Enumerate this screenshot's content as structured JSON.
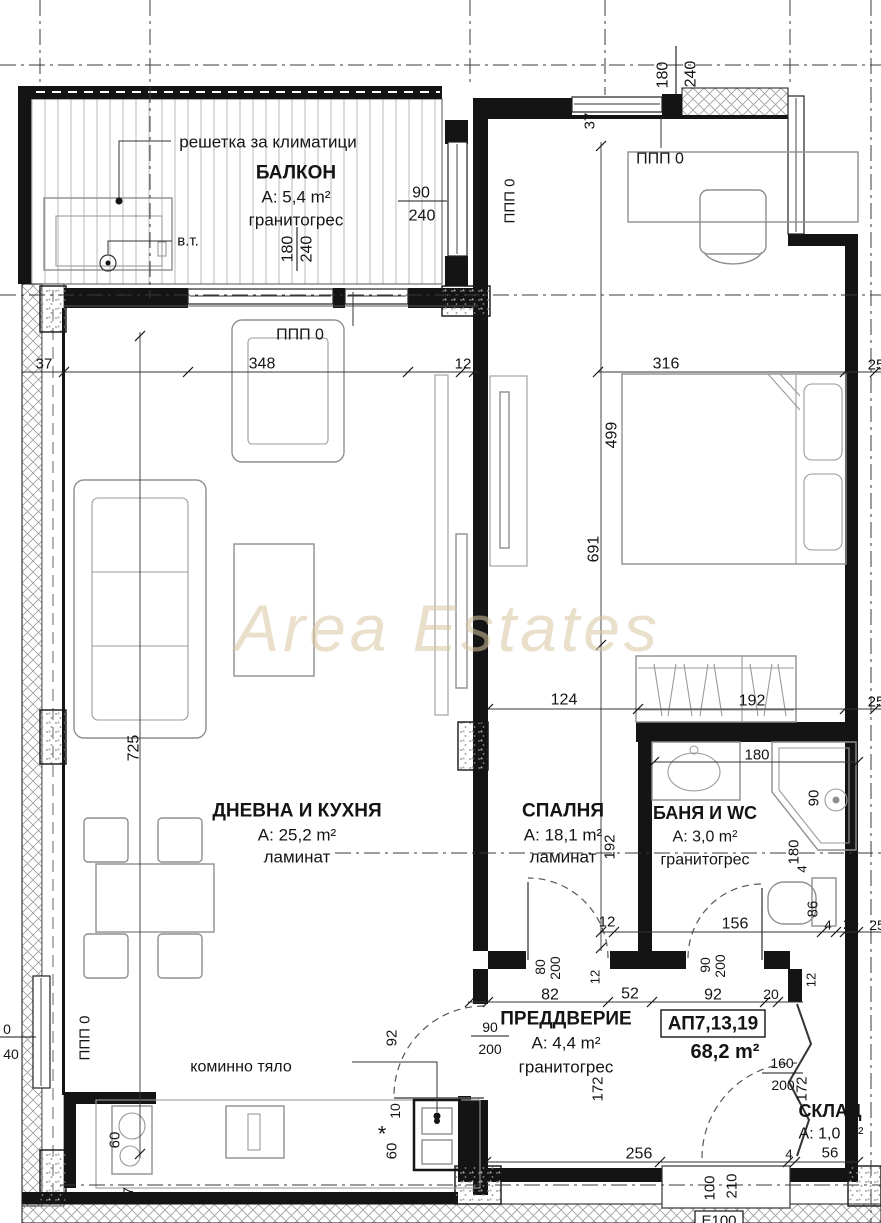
{
  "apartment": {
    "id": "АП7,13,19",
    "total_area": "68,2 m²"
  },
  "watermark": "Area Estates",
  "rooms": [
    {
      "name": "БАЛКОН",
      "area": "A: 5,4 m²",
      "floor": "гранитогрес"
    },
    {
      "name": "ДНЕВНА И КУХНЯ",
      "area": "A: 25,2 m²",
      "floor": "ламинат"
    },
    {
      "name": "СПАЛНЯ",
      "area": "A: 18,1 m²",
      "floor": "ламинат"
    },
    {
      "name": "БАНЯ И WC",
      "area": "A: 3,0 m²",
      "floor": "гранитогрес"
    },
    {
      "name": "ПРЕДДВЕРИЕ",
      "area": "A: 4,4 m²",
      "floor": "гранитогрес"
    },
    {
      "name": "СКЛАД",
      "area": "A: 1,0 m²",
      "floor": ""
    }
  ],
  "annotations": [
    "решетка за климатици",
    "в.т.",
    "коминно тяло",
    "ППП 0",
    "Е100"
  ],
  "texts": [
    {
      "n": "balcony-name",
      "t": "БАЛКОН",
      "x": 296,
      "y": 173,
      "s": 19,
      "b": 1
    },
    {
      "n": "balcony-area",
      "t": "A: 5,4 m²",
      "x": 296,
      "y": 197,
      "s": 17
    },
    {
      "n": "balcony-floor",
      "t": "гранитогрес",
      "x": 296,
      "y": 220,
      "s": 17
    },
    {
      "n": "ac-grille-label",
      "t": "решетка за климатици",
      "x": 268,
      "y": 142,
      "s": 17
    },
    {
      "n": "vt-label",
      "t": "в.т.",
      "x": 188,
      "y": 241,
      "s": 15
    },
    {
      "t": "90",
      "x": 421,
      "y": 193,
      "s": 16
    },
    {
      "t": "240",
      "x": 422,
      "y": 216,
      "s": 16
    },
    {
      "t": "180",
      "x": 288,
      "y": 249,
      "s": 16,
      "r": -90
    },
    {
      "t": "240",
      "x": 307,
      "y": 249,
      "s": 16,
      "r": -90
    },
    {
      "t": "37",
      "x": 131,
      "y": 297,
      "s": 15,
      "r": -90
    },
    {
      "n": "ppp-living",
      "t": "ППП 0",
      "x": 300,
      "y": 335,
      "s": 16
    },
    {
      "t": "348",
      "x": 262,
      "y": 364,
      "s": 16
    },
    {
      "t": "12",
      "x": 463,
      "y": 364,
      "s": 15
    },
    {
      "t": "37",
      "x": 44,
      "y": 364,
      "s": 15
    },
    {
      "n": "ppp-balcony-window",
      "t": "ППП 0",
      "x": 510,
      "y": 201,
      "s": 15,
      "r": -90
    },
    {
      "t": "180",
      "x": 663,
      "y": 75,
      "s": 16,
      "r": -90
    },
    {
      "t": "240",
      "x": 691,
      "y": 74,
      "s": 16,
      "r": -90
    },
    {
      "t": "37",
      "x": 590,
      "y": 121,
      "s": 15,
      "r": -90
    },
    {
      "n": "ppp-bedroom",
      "t": "ППП 0",
      "x": 660,
      "y": 159,
      "s": 16
    },
    {
      "t": "316",
      "x": 666,
      "y": 364,
      "s": 16
    },
    {
      "t": "25",
      "x": 876,
      "y": 365,
      "s": 15
    },
    {
      "t": "499",
      "x": 612,
      "y": 435,
      "s": 16,
      "r": -90
    },
    {
      "t": "691",
      "x": 594,
      "y": 549,
      "s": 16,
      "r": -90
    },
    {
      "t": "124",
      "x": 564,
      "y": 700,
      "s": 16
    },
    {
      "t": "192",
      "x": 752,
      "y": 701,
      "s": 16
    },
    {
      "t": "25",
      "x": 876,
      "y": 702,
      "s": 15
    },
    {
      "t": "725",
      "x": 134,
      "y": 748,
      "s": 16,
      "r": -90
    },
    {
      "n": "living-name",
      "t": "ДНЕВНА И КУХНЯ",
      "x": 297,
      "y": 811,
      "s": 19,
      "b": 1
    },
    {
      "n": "living-area",
      "t": "A: 25,2 m²",
      "x": 297,
      "y": 835,
      "s": 17
    },
    {
      "n": "living-floor",
      "t": "ламинат",
      "x": 297,
      "y": 857,
      "s": 17
    },
    {
      "n": "bedroom-name",
      "t": "СПАЛНЯ",
      "x": 563,
      "y": 811,
      "s": 19,
      "b": 1
    },
    {
      "n": "bedroom-area",
      "t": "A: 18,1 m²",
      "x": 563,
      "y": 835,
      "s": 17
    },
    {
      "n": "bedroom-floor",
      "t": "ламинат",
      "x": 563,
      "y": 857,
      "s": 17
    },
    {
      "t": "192",
      "x": 610,
      "y": 847,
      "s": 15,
      "r": -90
    },
    {
      "n": "bath-name",
      "t": "БАНЯ И WC",
      "x": 705,
      "y": 813,
      "s": 18,
      "b": 1
    },
    {
      "n": "bath-area",
      "t": "A: 3,0 m²",
      "x": 705,
      "y": 837,
      "s": 16
    },
    {
      "n": "bath-floor",
      "t": "гранитогрес",
      "x": 705,
      "y": 860,
      "s": 16
    },
    {
      "t": "180",
      "x": 757,
      "y": 755,
      "s": 15
    },
    {
      "t": "90",
      "x": 814,
      "y": 798,
      "s": 15,
      "r": -90
    },
    {
      "t": "180",
      "x": 794,
      "y": 852,
      "s": 15,
      "r": -90
    },
    {
      "t": "4",
      "x": 802,
      "y": 869,
      "s": 13,
      "r": -90
    },
    {
      "t": "86",
      "x": 813,
      "y": 909,
      "s": 15,
      "r": -90
    },
    {
      "t": "12",
      "x": 607,
      "y": 922,
      "s": 15
    },
    {
      "t": "156",
      "x": 735,
      "y": 924,
      "s": 16
    },
    {
      "t": "4",
      "x": 828,
      "y": 925,
      "s": 13
    },
    {
      "t": "20",
      "x": 851,
      "y": 924,
      "s": 14
    },
    {
      "t": "25",
      "x": 877,
      "y": 925,
      "s": 14
    },
    {
      "t": "90",
      "x": 705,
      "y": 965,
      "s": 14,
      "r": -90
    },
    {
      "t": "200",
      "x": 720,
      "y": 966,
      "s": 14,
      "r": -90
    },
    {
      "t": "80",
      "x": 540,
      "y": 967,
      "s": 14,
      "r": -90
    },
    {
      "t": "200",
      "x": 555,
      "y": 968,
      "s": 14,
      "r": -90
    },
    {
      "t": "10",
      "x": 479,
      "y": 994,
      "s": 13
    },
    {
      "t": "82",
      "x": 550,
      "y": 995,
      "s": 16
    },
    {
      "t": "52",
      "x": 630,
      "y": 994,
      "s": 16
    },
    {
      "t": "92",
      "x": 713,
      "y": 995,
      "s": 16
    },
    {
      "t": "20",
      "x": 771,
      "y": 994,
      "s": 14
    },
    {
      "t": "12",
      "x": 595,
      "y": 977,
      "s": 13,
      "r": -90
    },
    {
      "t": "12",
      "x": 811,
      "y": 980,
      "s": 13,
      "r": -90
    },
    {
      "n": "hall-name",
      "t": "ПРЕДДВЕРИЕ",
      "x": 566,
      "y": 1019,
      "s": 19,
      "b": 1
    },
    {
      "n": "hall-area",
      "t": "A: 4,4 m²",
      "x": 566,
      "y": 1043,
      "s": 17
    },
    {
      "n": "hall-floor",
      "t": "гранитогрес",
      "x": 566,
      "y": 1067,
      "s": 17
    },
    {
      "n": "apartment-id",
      "t": "АП7,13,19",
      "x": 713,
      "y": 1024,
      "s": 19,
      "b": 1
    },
    {
      "n": "apartment-total-area",
      "t": "68,2 m²",
      "x": 725,
      "y": 1052,
      "s": 20,
      "b": 1
    },
    {
      "t": "90",
      "x": 490,
      "y": 1027,
      "s": 14
    },
    {
      "t": "200",
      "x": 490,
      "y": 1049,
      "s": 14
    },
    {
      "t": "92",
      "x": 392,
      "y": 1038,
      "s": 15,
      "r": -90
    },
    {
      "t": "10",
      "x": 395,
      "y": 1111,
      "s": 14,
      "r": -90
    },
    {
      "n": "asterisk-note",
      "t": "*",
      "x": 382,
      "y": 1134,
      "s": 22
    },
    {
      "t": "60",
      "x": 392,
      "y": 1151,
      "s": 15,
      "r": -90
    },
    {
      "n": "chimney-label",
      "t": "коминно тяло",
      "x": 241,
      "y": 1067,
      "s": 16
    },
    {
      "t": "0",
      "x": 7,
      "y": 1029,
      "s": 14
    },
    {
      "t": "40",
      "x": 11,
      "y": 1054,
      "s": 14
    },
    {
      "n": "ppp-kitchen",
      "t": "ППП 0",
      "x": 85,
      "y": 1038,
      "s": 15,
      "r": -90
    },
    {
      "t": "60",
      "x": 115,
      "y": 1140,
      "s": 15,
      "r": -90
    },
    {
      "t": "37",
      "x": 128,
      "y": 1195,
      "s": 14,
      "r": -90
    },
    {
      "t": "256",
      "x": 639,
      "y": 1154,
      "s": 16
    },
    {
      "t": "100",
      "x": 710,
      "y": 1188,
      "s": 15,
      "r": -90
    },
    {
      "t": "210",
      "x": 732,
      "y": 1186,
      "s": 15,
      "r": -90
    },
    {
      "t": "4",
      "x": 789,
      "y": 1154,
      "s": 13
    },
    {
      "t": "56",
      "x": 830,
      "y": 1153,
      "s": 15
    },
    {
      "t": "160",
      "x": 782,
      "y": 1063,
      "s": 14
    },
    {
      "t": "200",
      "x": 783,
      "y": 1085,
      "s": 14
    },
    {
      "t": "172",
      "x": 598,
      "y": 1089,
      "s": 15,
      "r": -90
    },
    {
      "t": "172",
      "x": 802,
      "y": 1089,
      "s": 15,
      "r": -90
    },
    {
      "n": "storage-name",
      "t": "СКЛАД",
      "x": 830,
      "y": 1111,
      "s": 18,
      "b": 1
    },
    {
      "n": "storage-area",
      "t": "A: 1,0 m²",
      "x": 831,
      "y": 1134,
      "s": 16
    },
    {
      "n": "stairwell-label",
      "t": "Е100",
      "x": 719,
      "y": 1221,
      "s": 15
    },
    {
      "n": "watermark",
      "t": "Area Estates",
      "x": 448,
      "y": 628,
      "s": 66,
      "i": 1,
      "c": "#d8c5a0",
      "o": 0.55
    }
  ]
}
